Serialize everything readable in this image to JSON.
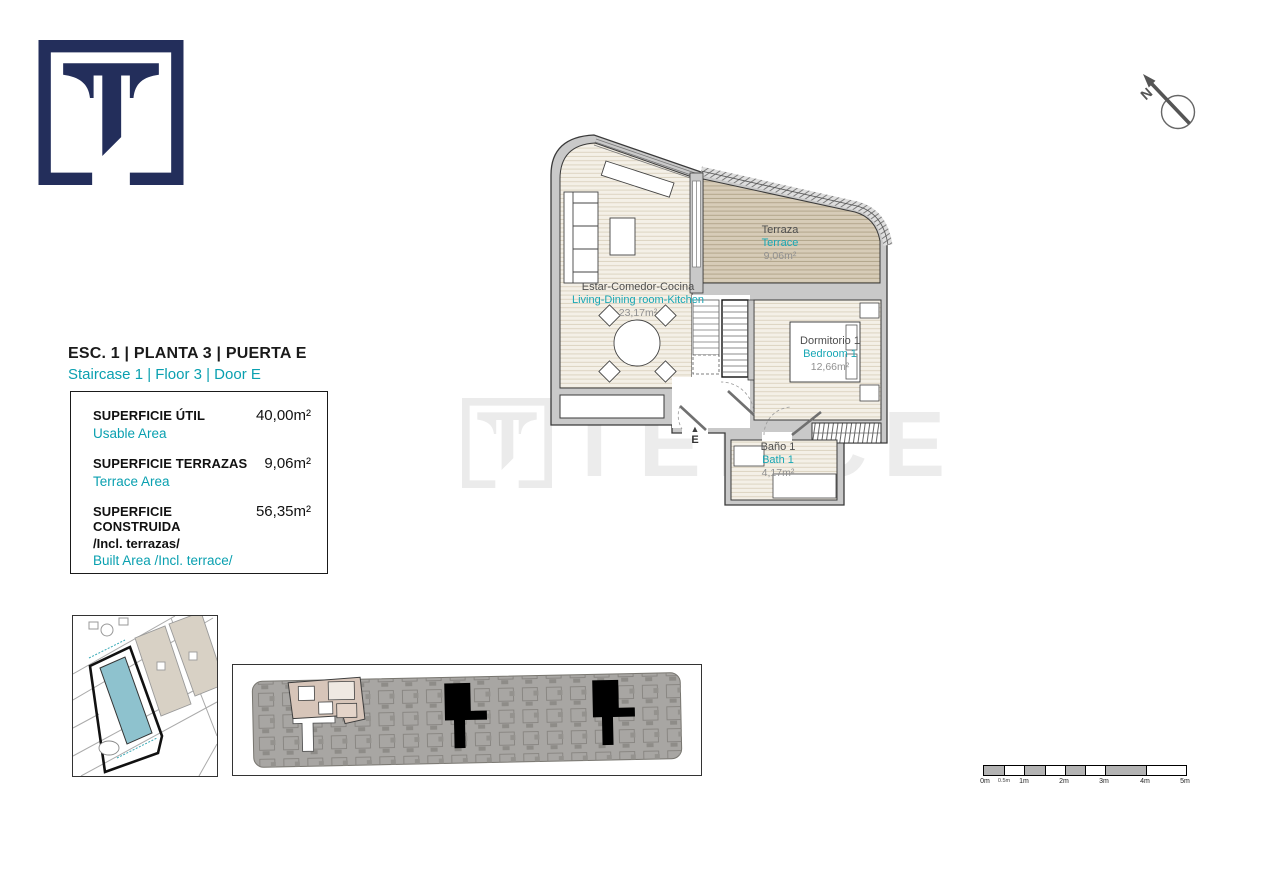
{
  "brand": {
    "navy": "#232e5b",
    "teal": "#0aa0b0",
    "watermark_text": "TEKCE"
  },
  "header": {
    "title_es": "ESC. 1 | PLANTA 3 | PUERTA E",
    "title_en": "Staircase 1 | Floor 3 | Door E"
  },
  "area_table": {
    "rows": [
      {
        "label_es": "SUPERFICIE ÚTIL",
        "label_en": "Usable Area",
        "value": "40,00m²"
      },
      {
        "label_es": "SUPERFICIE TERRAZAS",
        "label_en": "Terrace Area",
        "value": "9,06m²"
      },
      {
        "label_es": "SUPERFICIE CONSTRUIDA",
        "label_es2": "/Incl. terrazas/",
        "label_en": "Built Area /Incl. terrace/",
        "value": "56,35m²"
      }
    ]
  },
  "floor_plan": {
    "living": {
      "name_es": "Estar-Comedor-Cocina",
      "name_en": "Living-Dining room-Kitchen",
      "area": "23,17m²"
    },
    "terrace": {
      "name_es": "Terraza",
      "name_en": "Terrace",
      "area": "9,06m²"
    },
    "bedroom": {
      "name_es": "Dormitorio 1",
      "name_en": "Bedroom 1",
      "area": "12,66m²"
    },
    "bath": {
      "name_es": "Baño 1",
      "name_en": "Bath 1",
      "area": "4,17m²"
    },
    "entrance_label": "E",
    "entrance_marker": "▲"
  },
  "compass": {
    "label": "N"
  },
  "scale_bar": {
    "labels": [
      "0m",
      "0.5m",
      "1m",
      "2m",
      "3m",
      "4m",
      "5m"
    ]
  }
}
